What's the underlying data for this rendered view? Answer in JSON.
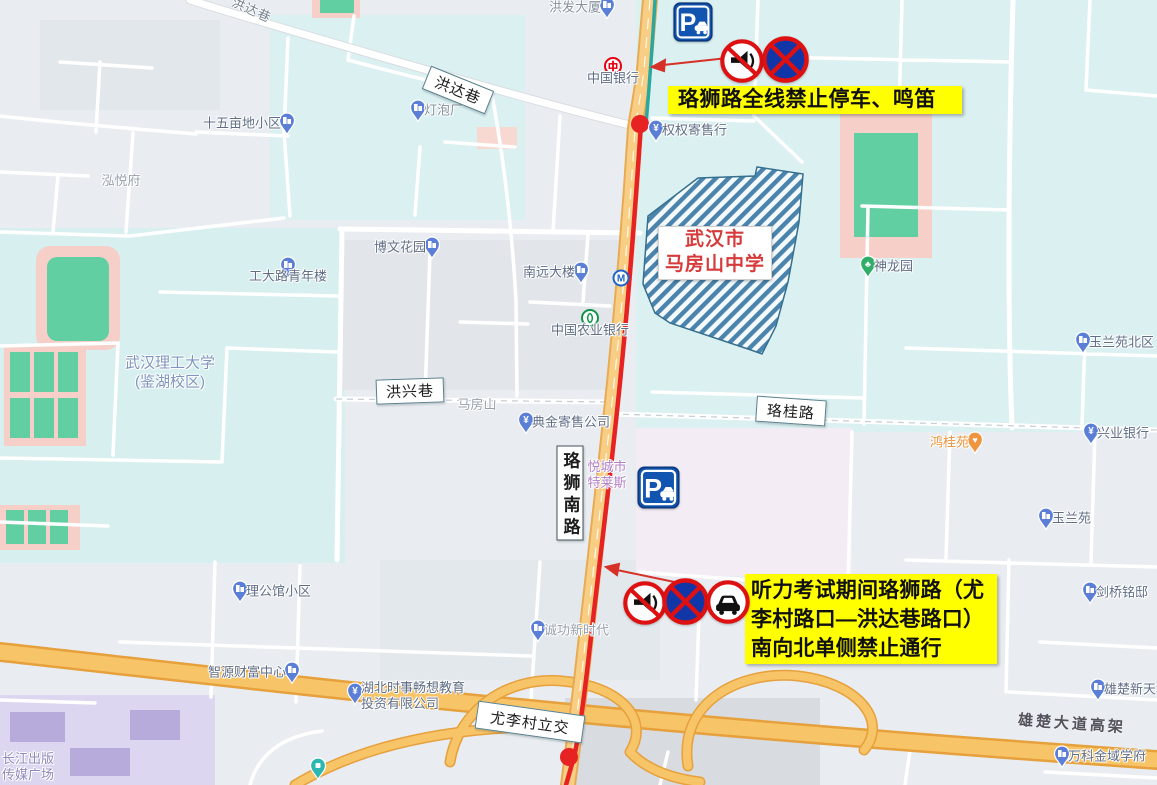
{
  "map": {
    "school_label": {
      "line1": "武汉市",
      "line2": "马房山中学"
    },
    "annotation_top": "珞狮路全线禁止停车、鸣笛",
    "annotation_bottom": [
      "听力考试期间珞狮路（尤",
      "李村路口—洪达巷路口）",
      "南向北单侧禁止通行"
    ],
    "road_labels": [
      {
        "id": "hongda-lane",
        "text": "洪达巷",
        "x": 458,
        "y": 90,
        "w": 68,
        "h": 25,
        "rot": 22
      },
      {
        "id": "hongxing-lane",
        "text": "洪兴巷",
        "x": 410,
        "y": 391,
        "w": 68,
        "h": 25,
        "rot": -2
      },
      {
        "id": "luogui-road",
        "text": "珞桂路",
        "x": 791,
        "y": 411,
        "w": 70,
        "h": 26,
        "rot": 4
      },
      {
        "id": "youlicun-interchange",
        "text": "尤李村立交",
        "x": 530,
        "y": 722,
        "w": 108,
        "h": 28,
        "rot": 8
      },
      {
        "id": "luoshi-south-road",
        "text": "珞狮南路",
        "x": 570,
        "y": 493,
        "w": 27,
        "h": 95,
        "rot": 0,
        "vertical": true
      }
    ],
    "road_names_plain": [
      {
        "id": "hongda-lane-top",
        "text": "洪达巷",
        "x": 252,
        "y": 9,
        "rot": 24,
        "cls": ""
      },
      {
        "id": "xiongchu-viaduct",
        "text": "雄楚大道高架",
        "x": 1072,
        "y": 723,
        "rot": 4,
        "cls": "highway"
      }
    ],
    "pois": [
      {
        "type": "building",
        "x": 607,
        "y": 7,
        "label": "洪发大厦",
        "side": "left",
        "cls": "gray"
      },
      {
        "type": "boc",
        "x": 613,
        "y": 66,
        "label": "中国银行",
        "side": "below"
      },
      {
        "type": "yuan",
        "x": 656,
        "y": 130,
        "label": "权权寄售行",
        "side": "right"
      },
      {
        "type": "building",
        "x": 418,
        "y": 110,
        "label": "灯泡厂",
        "side": "right",
        "cls": "gray"
      },
      {
        "type": "building",
        "x": 287,
        "y": 123,
        "label": "十五亩地小区",
        "side": "left"
      },
      {
        "type": "none",
        "x": 121,
        "y": 181,
        "label": "泓悦府",
        "side": "center",
        "cls": "faint"
      },
      {
        "type": "building",
        "x": 432,
        "y": 247,
        "label": "博文花园",
        "side": "left"
      },
      {
        "type": "building",
        "x": 581,
        "y": 272,
        "label": "南远大楼",
        "side": "left"
      },
      {
        "type": "building",
        "x": 288,
        "y": 267,
        "label": "工大路青年楼",
        "side": "below"
      },
      {
        "type": "abc",
        "x": 590,
        "y": 318,
        "label": "中国农业银行",
        "side": "below"
      },
      {
        "type": "none",
        "x": 170,
        "y": 373,
        "label": "武汉理工大学",
        "label2": "(鉴湖校区)",
        "side": "center",
        "cls": "campus"
      },
      {
        "type": "none",
        "x": 477,
        "y": 405,
        "label": "马房山",
        "side": "center",
        "cls": "faint"
      },
      {
        "type": "yuan",
        "x": 526,
        "y": 422,
        "label": "典金寄售公司",
        "side": "right"
      },
      {
        "type": "metro",
        "x": 621,
        "y": 278,
        "label": "",
        "side": "right"
      },
      {
        "type": "none",
        "x": 607,
        "y": 475,
        "label": "悦城市",
        "label2": "特莱斯",
        "side": "center",
        "cls": "purple"
      },
      {
        "type": "park",
        "x": 868,
        "y": 266,
        "label": "神龙园",
        "side": "right"
      },
      {
        "type": "building",
        "x": 1083,
        "y": 342,
        "label": "玉兰苑北区",
        "side": "right"
      },
      {
        "type": "yuan",
        "x": 1091,
        "y": 433,
        "label": "兴业银行",
        "side": "right"
      },
      {
        "type": "heart",
        "x": 975,
        "y": 442,
        "label": "鸿桂苑",
        "side": "left",
        "cls": "orange"
      },
      {
        "type": "building",
        "x": 1046,
        "y": 518,
        "label": "玉兰苑",
        "side": "right"
      },
      {
        "type": "building",
        "x": 1090,
        "y": 592,
        "label": "剑桥铭邸",
        "side": "right"
      },
      {
        "type": "building",
        "x": 240,
        "y": 591,
        "label": "理公馆小区",
        "side": "right"
      },
      {
        "type": "building",
        "x": 292,
        "y": 672,
        "label": "智源财富中心",
        "side": "left"
      },
      {
        "type": "yuan",
        "x": 355,
        "y": 693,
        "label": "湖北时事畅想教育",
        "label2": "投资有限公司",
        "side": "right2"
      },
      {
        "type": "building",
        "x": 538,
        "y": 630,
        "label": "诚功新时代",
        "side": "right",
        "cls": "faint"
      },
      {
        "type": "building",
        "x": 1098,
        "y": 689,
        "label": "雄楚新天地",
        "side": "right"
      },
      {
        "type": "building",
        "x": 1062,
        "y": 756,
        "label": "万科金域学府",
        "side": "right"
      },
      {
        "type": "none",
        "x": 28,
        "y": 767,
        "label": "长江出版",
        "label2": "传媒广场",
        "side": "center",
        "cls": "purple2"
      },
      {
        "type": "teal",
        "x": 318,
        "y": 768,
        "label": "",
        "side": "right"
      }
    ],
    "signs": [
      {
        "name": "parking-sign-top",
        "type": "parking",
        "x": 673,
        "y": 2,
        "size": 40
      },
      {
        "name": "no-horn-sign-top",
        "type": "no-horn",
        "x": 720,
        "y": 39,
        "size": 44
      },
      {
        "name": "no-stopping-sign-top",
        "type": "no-stop",
        "x": 762,
        "y": 36,
        "size": 47
      },
      {
        "name": "parking-sign-mid",
        "type": "parking",
        "x": 637,
        "y": 466,
        "size": 43
      },
      {
        "name": "no-horn-sign-bottom",
        "type": "no-horn",
        "x": 623,
        "y": 581,
        "size": 44
      },
      {
        "name": "no-stopping-sign-bottom",
        "type": "no-stop",
        "x": 662,
        "y": 578,
        "size": 47
      },
      {
        "name": "no-vehicles-sign-bottom",
        "type": "no-car",
        "x": 706,
        "y": 580,
        "size": 44
      }
    ]
  },
  "colors": {
    "annotation_bg": "#FFFF00",
    "restricted_route": "#E62222",
    "school_hatch": "#4A84AD",
    "school_text": "#D63A3A",
    "main_road": "#F8CE84",
    "highway": "#F7C468",
    "metro_teal": "#2AA8A0"
  }
}
